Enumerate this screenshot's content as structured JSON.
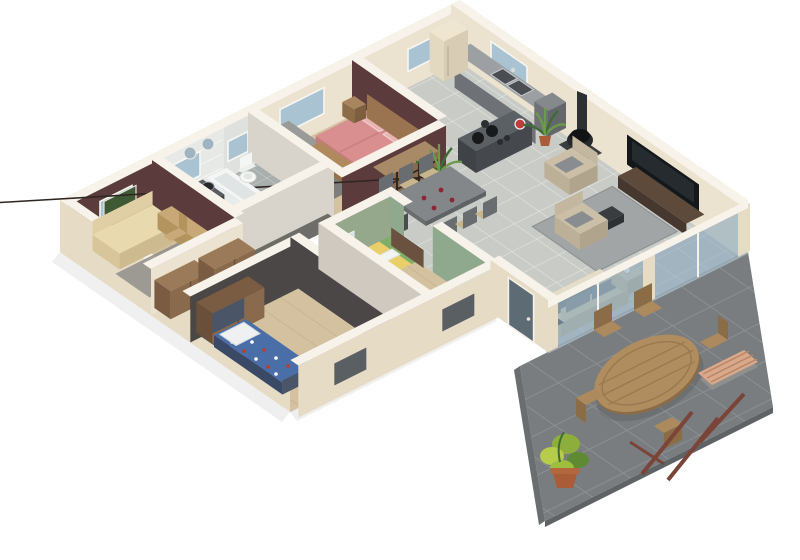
{
  "scene": {
    "type": "isometric-3d-floor-plan-render",
    "background": "#ffffff",
    "house": {
      "rooms": [
        {
          "id": "office",
          "label": "office-guest-room",
          "wall_color_key": "wall_maroon",
          "furniture": [
            "daybed-sofa",
            "desk",
            "desk-chair",
            "area-rug",
            "wall-picture",
            "window"
          ]
        },
        {
          "id": "bathroom",
          "label": "bathroom",
          "wall_color_key": "tile_wall",
          "furniture": [
            "bathtub",
            "double-sink-vanity",
            "round-mirrors",
            "window"
          ]
        },
        {
          "id": "wc",
          "label": "toilet-room",
          "furniture": [
            "toilet",
            "small-window"
          ]
        },
        {
          "id": "master-bedroom",
          "label": "master-bedroom",
          "wall_color_key": "wall_maroon",
          "furniture": [
            "double-bed-pink",
            "headboard",
            "nightstand",
            "nightstand",
            "blanket-chest",
            "gray-wardrobe",
            "window"
          ]
        },
        {
          "id": "kitchen",
          "label": "kitchen",
          "furniture": [
            "wall-counter-with-two-sinks",
            "kitchen-window",
            "fridge",
            "tall-cabinet",
            "island-with-cooktop",
            "red-bowl",
            "potted-palm"
          ]
        },
        {
          "id": "living-dining",
          "label": "living-dining-room",
          "furniture": [
            "dining-table",
            "six-dining-chairs",
            "wine-glasses",
            "wood-stove",
            "wall-tv",
            "tv-console",
            "gray-rug",
            "coffee-table",
            "armchair",
            "armchair",
            "cream-sofa",
            "side-table-with-cup",
            "cubby-shelf",
            "potted-palm",
            "doormat"
          ]
        },
        {
          "id": "dressing",
          "label": "dressing-area",
          "furniture": [
            "wardrobe",
            "wardrobe"
          ]
        },
        {
          "id": "hallway",
          "label": "hallway",
          "furniture": []
        },
        {
          "id": "kids-bedroom-blue",
          "label": "kids-bedroom-blue",
          "furniture": [
            "single-bed-blue-pattern",
            "dark-wardrobe",
            "window-with-radiator"
          ]
        },
        {
          "id": "kids-bedroom-green",
          "label": "kids-bedroom-green",
          "wall_color_key": "wall_green",
          "furniture": [
            "single-bed-striped",
            "wall-poster",
            "window-with-radiator",
            "open-door"
          ]
        },
        {
          "id": "entry",
          "label": "entry",
          "furniture": [
            "front-door",
            "doormat"
          ]
        }
      ],
      "terrace": {
        "id": "terrace",
        "label": "outdoor-terrace",
        "furniture": [
          "oval-teak-table",
          "five-garden-chairs",
          "slatted-bench",
          "wood-posts",
          "potted-plant"
        ]
      }
    }
  },
  "palette": {
    "wall_outer": "#e6dcc6",
    "wall_inner": "#ece2d0",
    "wall_top": "#f7f3ea",
    "wall_maroon": "#5c3b3d",
    "wall_green": "#95a88c",
    "wall_dark": "#4b4747",
    "wall_gray": "#d8d4cc",
    "tile_wall": "#e7e9e6",
    "floor_wood": "#d4c1a0",
    "floor_tile": "#c9cbc7",
    "floor_bath": "#a9afad",
    "floor_hall": "#6f6d69",
    "terrace": "#797d7f",
    "glass": "#7fa2b8",
    "window_glass": "#a9c3d2",
    "island": "#555a5e",
    "counter": "#9ca0a3",
    "daybed": "#e8d9ae",
    "cushion": "#8a8d90",
    "bed_pink": "#d98f8f",
    "bed_blue": "#4a6fa8",
    "wood": "#9a7a58",
    "wood_dark": "#6a4f3a",
    "teak": "#b08d5f",
    "plant": "#6b9a4a",
    "plant_dark": "#3f6b35",
    "pot": "#a85c38",
    "accent_red": "#c23b3b",
    "tv_black": "#15181a",
    "rug": "#9fa2a4",
    "mat": "#55565a",
    "stove": "#26292b",
    "sofa": "#e6ddc8",
    "door_blue": "#5d6b75",
    "radiator": "#5a5f63",
    "bench_wood": "#d9a989",
    "pole": "#7a4438",
    "kid_stripe_green": "#7fae6a",
    "kid_stripe_blue": "#a8cce0",
    "kid_stripe_yellow": "#e8cf6a"
  }
}
